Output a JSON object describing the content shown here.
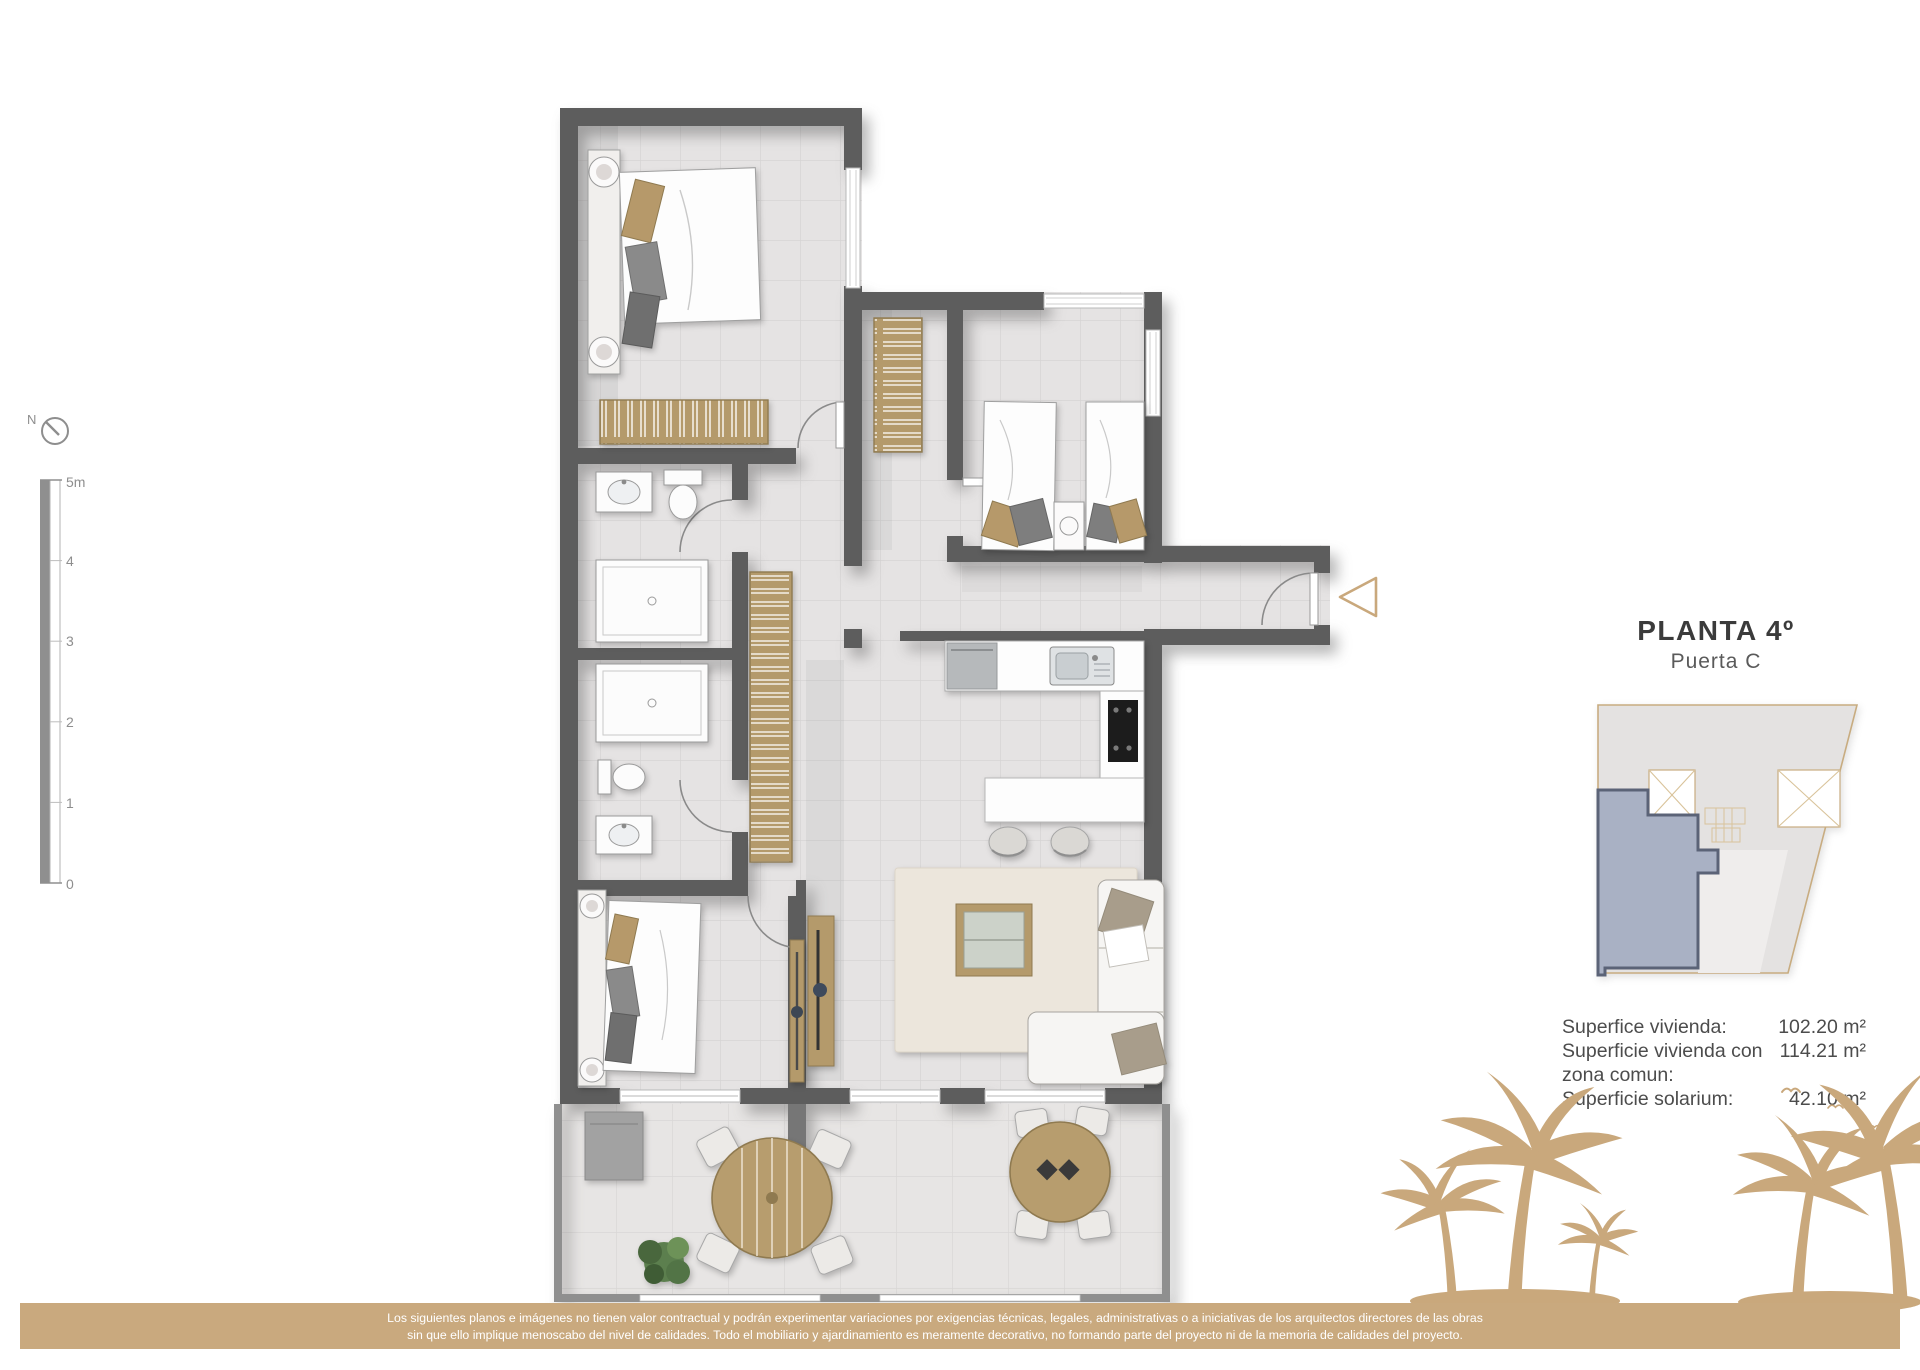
{
  "compass": {
    "label": "N"
  },
  "scale_bar": {
    "ticks": [
      "5m",
      "4",
      "3",
      "2",
      "1",
      "0"
    ]
  },
  "title": {
    "floor": "PLANTA 4º",
    "door": "Puerta C"
  },
  "areas": {
    "rows": [
      {
        "label": "Superfice vivienda:",
        "value": "102.20 m²"
      },
      {
        "label": "Superficie vivienda con",
        "label2": "zona comun:",
        "value": "114.21 m²"
      },
      {
        "label": "Superficie solarium:",
        "value": "42.10 m²"
      }
    ]
  },
  "disclaimer": {
    "line1": "Los siguientes planos e imágenes no tienen valor contractual y podrán experimentar variaciones por exigencias técnicas, legales, administrativas o a iniciativas de los arquitectos directores de las obras",
    "line2": "sin que ello implique menoscabo del nivel de calidades. Todo el mobiliario y ajardinamiento es meramente decorativo, no formando parte del proyecto ni de la memoria de calidades del proyecto."
  },
  "colors": {
    "accent_tan": "#c9a87c",
    "wall_gray": "#5d5d5d",
    "unit_highlight": "#a9b1c4",
    "unit_border": "#5b6377",
    "wood": "#b49a6b"
  }
}
